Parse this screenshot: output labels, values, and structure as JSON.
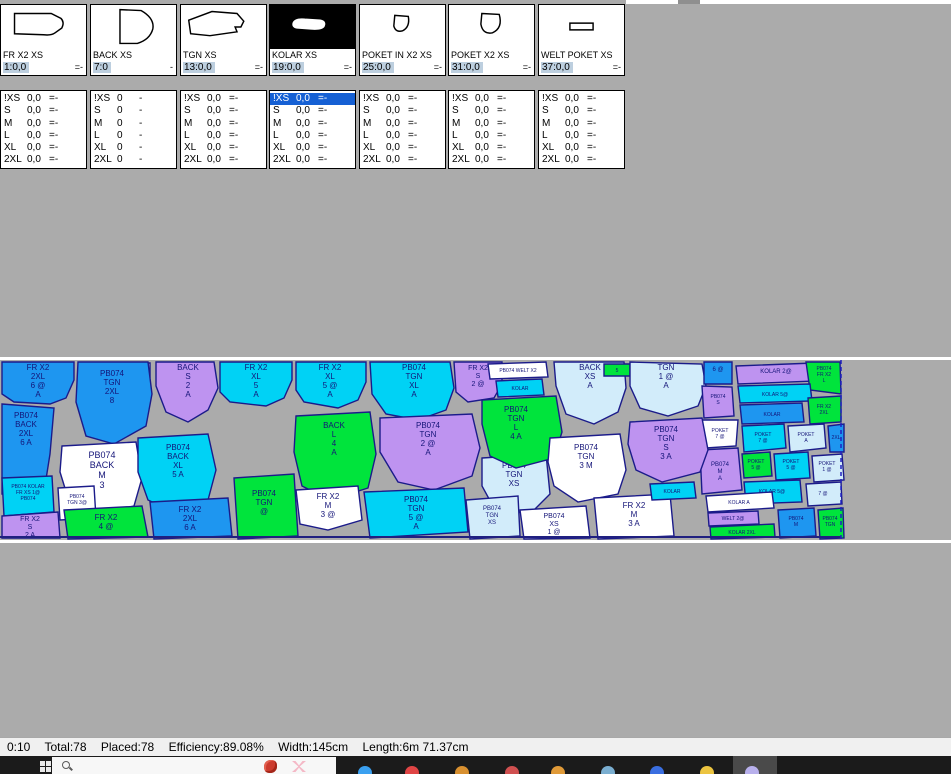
{
  "pattern_cards": [
    {
      "name": "FR X2 XS",
      "value": "1:0,0",
      "suffix": "=-",
      "shape": "fr",
      "selected": false
    },
    {
      "name": "BACK XS",
      "value": "7:0",
      "suffix": "-",
      "shape": "back",
      "selected": false
    },
    {
      "name": "TGN XS",
      "value": "13:0,0",
      "suffix": "=-",
      "shape": "tgn",
      "selected": false
    },
    {
      "name": "KOLAR XS",
      "value": "19:0,0",
      "suffix": "=-",
      "shape": "kolar",
      "selected": true
    },
    {
      "name": "POKET IN X2 XS",
      "value": "25:0,0",
      "suffix": "=-",
      "shape": "poket_in",
      "selected": false
    },
    {
      "name": "POKET X2 XS",
      "value": "31:0,0",
      "suffix": "=-",
      "shape": "poket",
      "selected": false
    },
    {
      "name": "WELT POKET XS",
      "value": "37:0,0",
      "suffix": "=-",
      "shape": "welt",
      "selected": false
    }
  ],
  "size_table": {
    "sizes": [
      "!XS",
      "S",
      "M",
      "L",
      "XL",
      "2XL"
    ],
    "columns": [
      {
        "val": "0,0",
        "suf": "=-",
        "selected_row": -1
      },
      {
        "val": "0",
        "suf": "-",
        "selected_row": -1
      },
      {
        "val": "0,0",
        "suf": "=-",
        "selected_row": -1
      },
      {
        "val": "0,0",
        "suf": "=-",
        "selected_row": 0
      },
      {
        "val": "0,0",
        "suf": "=-",
        "selected_row": -1
      },
      {
        "val": "0,0",
        "suf": "=-",
        "selected_row": -1
      },
      {
        "val": "0,0",
        "suf": "=-",
        "selected_row": -1
      }
    ]
  },
  "marker": {
    "outline": "#1b1b8a",
    "label_color": "#141478",
    "end_line_x": 841,
    "bottom_line_y": 177,
    "colors": {
      "b": "#1E96F0",
      "c": "#00D2F5",
      "p": "#BE93F0",
      "g": "#00E43C",
      "w": "#FFFFFF",
      "l": "#D2ECFA"
    },
    "pieces": [
      {
        "c": "b",
        "pts": "2,2 74,2 74,20 66,38 50,44 14,42 2,34",
        "lx": 38,
        "ly": 10,
        "fs": 8,
        "label": [
          "FR X2",
          "2XL",
          "6 @",
          "A"
        ]
      },
      {
        "c": "w",
        "pts": "118,3 150,3 150,17 118,17",
        "lx": 134,
        "ly": 11,
        "fs": 5,
        "label": [
          "4"
        ]
      },
      {
        "c": "b",
        "pts": "78,2 148,2 152,34 146,66 114,84 86,76 76,42",
        "lx": 112,
        "ly": 16,
        "fs": 8,
        "label": [
          "PB074",
          "TGN",
          "2XL",
          "8"
        ]
      },
      {
        "c": "p",
        "pts": "156,2 214,2 218,28 208,50 188,62 166,52 156,26",
        "lx": 188,
        "ly": 10,
        "fs": 8,
        "label": [
          "BACK",
          "S",
          "2",
          "A"
        ]
      },
      {
        "c": "c",
        "pts": "220,2 292,2 292,20 284,38 266,46 230,42 220,32",
        "lx": 256,
        "ly": 10,
        "fs": 8,
        "label": [
          "FR X2",
          "XL",
          "5",
          "A"
        ]
      },
      {
        "c": "c",
        "pts": "296,2 366,2 366,22 358,40 338,48 304,42 296,30",
        "lx": 330,
        "ly": 10,
        "fs": 8,
        "label": [
          "FR X2",
          "XL",
          "5 @",
          "A"
        ]
      },
      {
        "c": "c",
        "pts": "370,2 450,2 454,28 446,50 418,60 386,54 372,34",
        "lx": 414,
        "ly": 10,
        "fs": 8,
        "label": [
          "PB074",
          "TGN",
          "XL",
          "A"
        ]
      },
      {
        "c": "p",
        "pts": "454,2 502,2 502,24 494,38 468,42 456,32",
        "lx": 478,
        "ly": 10,
        "fs": 7,
        "label": [
          "FR X2",
          "S",
          "2 @"
        ]
      },
      {
        "c": "w",
        "pts": "488,4 546,2 548,17 490,19",
        "lx": 518,
        "ly": 12,
        "fs": 5,
        "label": [
          "PB074 WELT X2"
        ]
      },
      {
        "c": "c",
        "pts": "496,21 542,19 544,35 498,37",
        "lx": 520,
        "ly": 30,
        "fs": 5,
        "label": [
          "KOLAR"
        ]
      },
      {
        "c": "l",
        "pts": "554,2 624,2 626,28 618,52 594,64 566,54 556,26",
        "lx": 590,
        "ly": 10,
        "fs": 8,
        "label": [
          "BACK",
          "XS",
          "A"
        ]
      },
      {
        "c": "g",
        "pts": "604,4 630,4 630,16 604,16",
        "lx": 617,
        "ly": 12,
        "fs": 5,
        "label": [
          "5"
        ]
      },
      {
        "c": "l",
        "pts": "630,2 702,4 706,26 698,46 668,56 640,48 630,26",
        "lx": 666,
        "ly": 10,
        "fs": 8,
        "label": [
          "TGN",
          "1 @",
          "A"
        ]
      },
      {
        "c": "b",
        "pts": "704,2 732,2 732,24 704,24",
        "lx": 718,
        "ly": 11,
        "fs": 6,
        "label": [
          "6 @"
        ]
      },
      {
        "c": "p",
        "pts": "736,6 814,3 816,21 738,24",
        "lx": 776,
        "ly": 13,
        "fs": 6,
        "label": [
          "KOLAR 2@"
        ]
      },
      {
        "c": "g",
        "pts": "806,2 840,2 841,34 810,30",
        "lx": 824,
        "ly": 10,
        "fs": 5,
        "label": [
          "PB074",
          "FR X2",
          "L"
        ]
      },
      {
        "c": "c",
        "pts": "738,26 810,24 812,41 740,43",
        "lx": 775,
        "ly": 36,
        "fs": 5,
        "label": [
          "KOLAR 5@"
        ]
      },
      {
        "c": "p",
        "pts": "702,26 732,27 734,56 704,58",
        "lx": 718,
        "ly": 38,
        "fs": 5,
        "label": [
          "PB074",
          "S"
        ]
      },
      {
        "c": "b",
        "pts": "740,45 802,43 804,62 742,64",
        "lx": 772,
        "ly": 56,
        "fs": 5,
        "label": [
          "KOLAR"
        ]
      },
      {
        "c": "g",
        "pts": "808,38 841,36 841,62 810,64",
        "lx": 824,
        "ly": 48,
        "fs": 5,
        "label": [
          "FR X2",
          "2XL"
        ]
      },
      {
        "c": "w",
        "pts": "702,60 738,60 736,86 706,88",
        "lx": 720,
        "ly": 72,
        "fs": 5,
        "label": [
          "POKET",
          "7 @"
        ]
      },
      {
        "c": "c",
        "pts": "742,66 784,64 786,88 744,92",
        "lx": 763,
        "ly": 76,
        "fs": 5,
        "label": [
          "POKET",
          "7 @"
        ]
      },
      {
        "c": "l",
        "pts": "788,66 824,64 826,88 790,92",
        "lx": 806,
        "ly": 76,
        "fs": 5,
        "label": [
          "POKET",
          "A"
        ]
      },
      {
        "c": "b",
        "pts": "828,66 844,64 844,92 830,92",
        "lx": 836,
        "ly": 79,
        "fs": 5,
        "label": [
          "2XL"
        ]
      },
      {
        "c": "p",
        "pts": "700,90 738,88 742,130 702,134",
        "lx": 720,
        "ly": 106,
        "fs": 6,
        "label": [
          "PB074",
          "M",
          "A"
        ]
      },
      {
        "c": "g",
        "pts": "742,94 770,92 772,116 744,118",
        "lx": 756,
        "ly": 103,
        "fs": 5,
        "label": [
          "POKET",
          "5 @"
        ]
      },
      {
        "c": "c",
        "pts": "774,94 808,92 810,118 776,120",
        "lx": 791,
        "ly": 103,
        "fs": 5,
        "label": [
          "POKET",
          "5 @"
        ]
      },
      {
        "c": "l",
        "pts": "812,96 842,94 844,120 814,122",
        "lx": 827,
        "ly": 105,
        "fs": 5,
        "label": [
          "POKET",
          "1 @"
        ]
      },
      {
        "c": "c",
        "pts": "744,122 800,120 802,142 746,144",
        "lx": 772,
        "ly": 133,
        "fs": 5,
        "label": [
          "KOLAR 5@"
        ]
      },
      {
        "c": "l",
        "pts": "806,124 841,122 842,144 808,146",
        "lx": 823,
        "ly": 135,
        "fs": 5,
        "label": [
          "7 @"
        ]
      },
      {
        "c": "w",
        "pts": "706,136 772,132 774,148 708,152",
        "lx": 739,
        "ly": 144,
        "fs": 5,
        "label": [
          "KOLAR A"
        ]
      },
      {
        "c": "p",
        "pts": "708,153 758,151 759,164 709,166",
        "lx": 733,
        "ly": 160,
        "fs": 5,
        "label": [
          "WELT 2@"
        ]
      },
      {
        "c": "g",
        "pts": "710,167 774,164 775,177 711,179",
        "lx": 742,
        "ly": 174,
        "fs": 5,
        "label": [
          "KOLAR 2XL"
        ]
      },
      {
        "c": "b",
        "pts": "778,150 814,148 816,176 780,178",
        "lx": 796,
        "ly": 160,
        "fs": 5,
        "label": [
          "PB074",
          "M"
        ]
      },
      {
        "c": "g",
        "pts": "818,150 843,148 844,178 820,179",
        "lx": 830,
        "ly": 160,
        "fs": 5,
        "label": [
          "PB074",
          "TGN"
        ]
      },
      {
        "c": "b",
        "pts": "2,44 54,48 50,94 44,132 2,134",
        "lx": 26,
        "ly": 58,
        "fs": 8,
        "label": [
          "PB074",
          "BACK",
          "2XL",
          "6 A"
        ]
      },
      {
        "c": "w",
        "pts": "62,86 136,82 142,118 134,146 96,154 68,138 60,112",
        "lx": 102,
        "ly": 98,
        "fs": 9,
        "label": [
          "PB074",
          "BACK",
          "M",
          "3"
        ]
      },
      {
        "c": "c",
        "pts": "138,78 208,74 216,110 208,140 174,152 148,140 138,112",
        "lx": 178,
        "ly": 90,
        "fs": 8,
        "label": [
          "PB074",
          "BACK",
          "XL",
          "5 A"
        ]
      },
      {
        "c": "c",
        "pts": "2,118 52,116 54,152 4,156",
        "lx": 28,
        "ly": 128,
        "fs": 5,
        "label": [
          "PB074 KOLAR",
          "FR XS 1@",
          "PB074"
        ]
      },
      {
        "c": "p",
        "pts": "2,156 58,152 60,178 2,178",
        "lx": 30,
        "ly": 161,
        "fs": 7,
        "label": [
          "FR X2",
          "S",
          "2 A"
        ]
      },
      {
        "c": "w",
        "pts": "58,128 94,126 96,158 60,160",
        "lx": 77,
        "ly": 138,
        "fs": 5,
        "label": [
          "PB074",
          "TGN 3@"
        ]
      },
      {
        "c": "g",
        "pts": "64,150 142,146 148,177 68,179",
        "lx": 106,
        "ly": 160,
        "fs": 8,
        "label": [
          "FR X2",
          "4 @"
        ]
      },
      {
        "c": "b",
        "pts": "150,142 228,138 232,176 154,179",
        "lx": 190,
        "ly": 152,
        "fs": 8,
        "label": [
          "FR X2",
          "2XL",
          "6 A"
        ]
      },
      {
        "c": "g",
        "pts": "234,118 294,114 298,176 238,179",
        "lx": 264,
        "ly": 136,
        "fs": 8,
        "label": [
          "PB074",
          "TGN",
          "@"
        ]
      },
      {
        "c": "g",
        "pts": "296,56 370,52 376,94 368,128 330,140 302,126 294,92",
        "lx": 334,
        "ly": 68,
        "fs": 8,
        "label": [
          "BACK",
          "L",
          "4",
          "A"
        ]
      },
      {
        "c": "w",
        "pts": "296,130 358,126 362,160 328,170 300,164",
        "lx": 328,
        "ly": 139,
        "fs": 8,
        "label": [
          "FR X2",
          "M",
          "3 @"
        ]
      },
      {
        "c": "p",
        "pts": "380,58 472,54 480,88 472,116 434,130 398,122 380,92",
        "lx": 428,
        "ly": 68,
        "fs": 8,
        "label": [
          "PB074",
          "TGN",
          "2 @",
          "A"
        ]
      },
      {
        "c": "c",
        "pts": "364,132 464,128 468,172 370,178",
        "lx": 416,
        "ly": 142,
        "fs": 8,
        "label": [
          "PB074",
          "TGN",
          "5 @",
          "A"
        ]
      },
      {
        "c": "l",
        "pts": "482,98 546,94 550,134 530,154 494,148 482,126",
        "lx": 514,
        "ly": 108,
        "fs": 8,
        "label": [
          "PB074",
          "TGN",
          "XS"
        ]
      },
      {
        "c": "g",
        "pts": "482,40 556,36 562,72 554,98 516,108 490,96 482,64",
        "lx": 516,
        "ly": 52,
        "fs": 8,
        "label": [
          "PB074",
          "TGN",
          "L",
          "4 A"
        ]
      },
      {
        "c": "w",
        "pts": "550,78 620,74 626,110 618,134 578,142 554,126 548,102",
        "lx": 586,
        "ly": 90,
        "fs": 8,
        "label": [
          "PB074",
          "TGN",
          "3 M"
        ]
      },
      {
        "c": "p",
        "pts": "630,62 702,58 708,90 700,112 662,122 636,110 628,84",
        "lx": 666,
        "ly": 72,
        "fs": 8,
        "label": [
          "PB074",
          "TGN",
          "S",
          "3 A"
        ]
      },
      {
        "c": "w",
        "pts": "594,138 670,134 674,176 598,179",
        "lx": 634,
        "ly": 148,
        "fs": 8,
        "label": [
          "FR X2",
          "M",
          "3 A"
        ]
      },
      {
        "c": "w",
        "pts": "520,150 586,146 590,178 524,179",
        "lx": 554,
        "ly": 158,
        "fs": 7,
        "label": [
          "PB074",
          "XS",
          "1 @"
        ]
      },
      {
        "c": "l",
        "pts": "466,140 518,136 520,176 470,179",
        "lx": 492,
        "ly": 150,
        "fs": 6,
        "label": [
          "PB074",
          "TGN",
          "XS"
        ]
      },
      {
        "c": "c",
        "pts": "650,124 694,122 696,138 652,140",
        "lx": 672,
        "ly": 133,
        "fs": 5,
        "label": [
          "KOLAR"
        ]
      }
    ]
  },
  "status_bar": {
    "segments": [
      "0:10",
      "Total:78",
      "Placed:78",
      "Efficiency:89.08%",
      "Width:145cm",
      "Length:6m 71.37cm"
    ]
  },
  "taskbar": {
    "icons": [
      {
        "name": "taskbar-app-1",
        "x": 365,
        "color": "#3aa0f0",
        "active": false
      },
      {
        "name": "taskbar-app-2",
        "x": 412,
        "color": "#e04545",
        "active": false
      },
      {
        "name": "taskbar-app-3",
        "x": 462,
        "color": "#d89030",
        "active": false
      },
      {
        "name": "taskbar-app-4",
        "x": 512,
        "color": "#d05050",
        "active": false
      },
      {
        "name": "taskbar-app-5",
        "x": 558,
        "color": "#e09a38",
        "active": false
      },
      {
        "name": "taskbar-app-6",
        "x": 608,
        "color": "#7aaed0",
        "active": false
      },
      {
        "name": "taskbar-app-7",
        "x": 657,
        "color": "#3a6ee0",
        "active": false
      },
      {
        "name": "taskbar-app-8",
        "x": 707,
        "color": "#ecc440",
        "active": false
      },
      {
        "name": "taskbar-app-9",
        "x": 752,
        "color": "#b8b0ec",
        "active": true
      }
    ]
  }
}
